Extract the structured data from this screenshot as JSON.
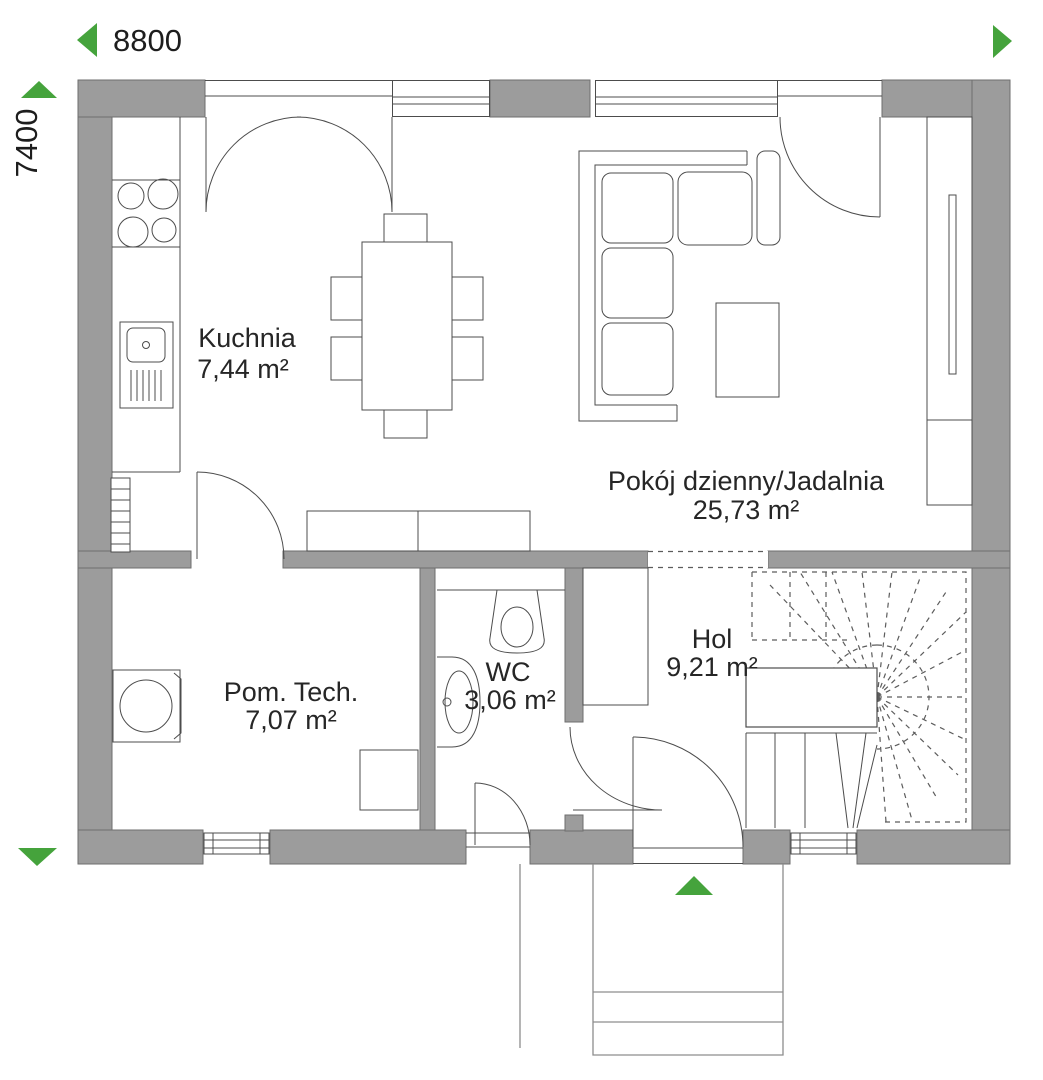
{
  "dimensions": {
    "width_mm": "8800",
    "height_mm": "7400"
  },
  "rooms": {
    "kitchen": {
      "name": "Kuchnia",
      "area": "7,44 m²"
    },
    "living": {
      "name": "Pokój dzienny/Jadalnia",
      "area": "25,73 m²"
    },
    "technical": {
      "name": "Pom. Tech.",
      "area": "7,07 m²"
    },
    "wc": {
      "name": "WC",
      "area": "3,06 m²"
    },
    "hall": {
      "name": "Hol",
      "area": "9,21 m²"
    }
  },
  "colors": {
    "wall": "#9c9c9c",
    "accent_green": "#45a33c",
    "line": "#4c4c4c"
  },
  "icons": {
    "dimension_arrow_left": "triangle-left",
    "dimension_arrow_right": "triangle-right",
    "dimension_arrow_up": "triangle-up",
    "dimension_arrow_down": "triangle-down",
    "entrance_arrow": "triangle-up"
  }
}
